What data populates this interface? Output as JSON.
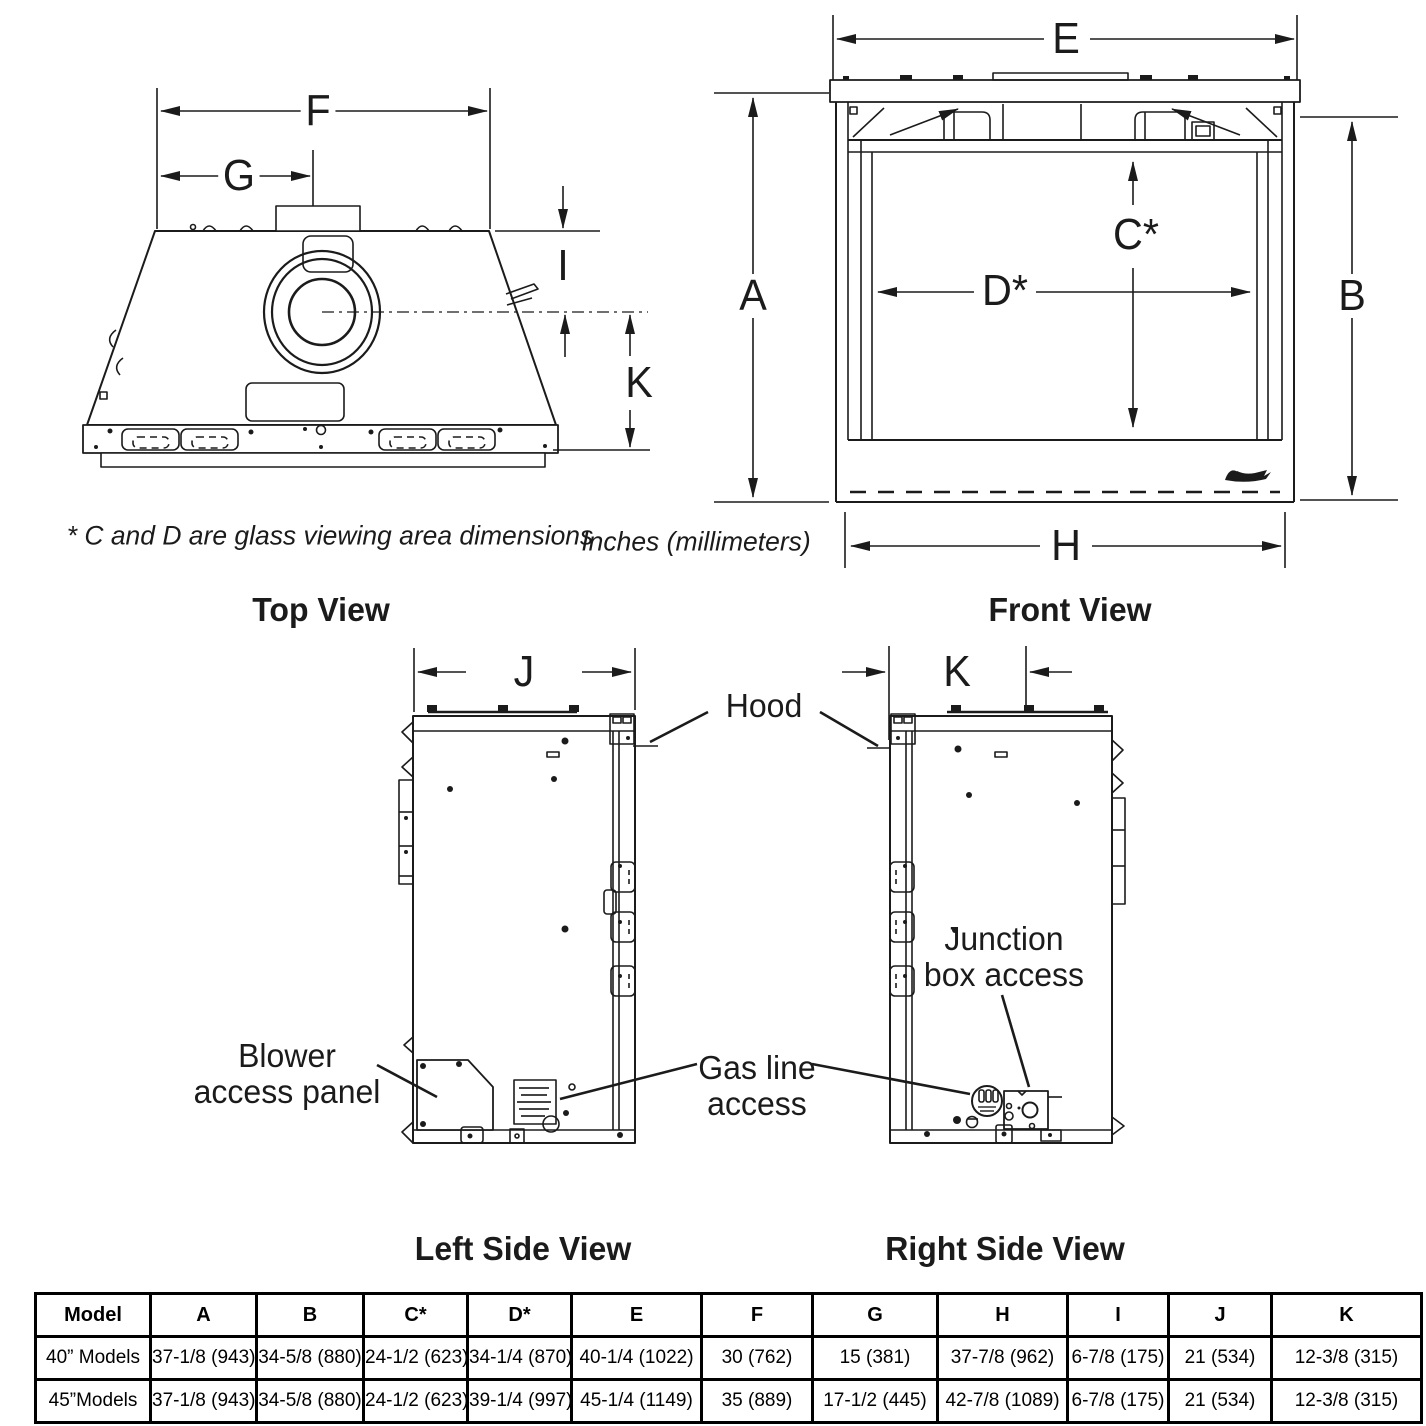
{
  "dim_labels": {
    "A": "A",
    "B": "B",
    "C": "C*",
    "D": "D*",
    "E": "E",
    "F": "F",
    "G": "G",
    "H": "H",
    "I": "I",
    "J": "J",
    "K": "K"
  },
  "annotations": {
    "hood": "Hood",
    "blower_line1": "Blower",
    "blower_line2": "access panel",
    "gas_line1": "Gas line",
    "gas_line2": "access",
    "junction_line1": "Junction",
    "junction_line2": "box access"
  },
  "notes": {
    "glass_note": "* C and D are glass viewing area dimensions",
    "units_note": "Inches (millimeters)"
  },
  "view_titles": {
    "top": "Top View",
    "front": "Front View",
    "left": "Left Side View",
    "right": "Right Side View"
  },
  "table": {
    "headers": [
      "Model",
      "A",
      "B",
      "C*",
      "D*",
      "E",
      "F",
      "G",
      "H",
      "I",
      "J",
      "K"
    ],
    "rows": [
      [
        "40” Models",
        "37-1/8 (943)",
        "34-5/8 (880)",
        "24-1/2 (623)",
        "34-1/4 (870)",
        "40-1/4 (1022)",
        "30 (762)",
        "15 (381)",
        "37-7/8 (962)",
        "6-7/8 (175)",
        "21 (534)",
        "12-3/8 (315)"
      ],
      [
        "45”Models",
        "37-1/8 (943)",
        "34-5/8 (880)",
        "24-1/2 (623)",
        "39-1/4 (997)",
        "45-1/4 (1149)",
        "35 (889)",
        "17-1/2 (445)",
        "42-7/8 (1089)",
        "6-7/8 (175)",
        "21 (534)",
        "12-3/8 (315)"
      ]
    ]
  }
}
